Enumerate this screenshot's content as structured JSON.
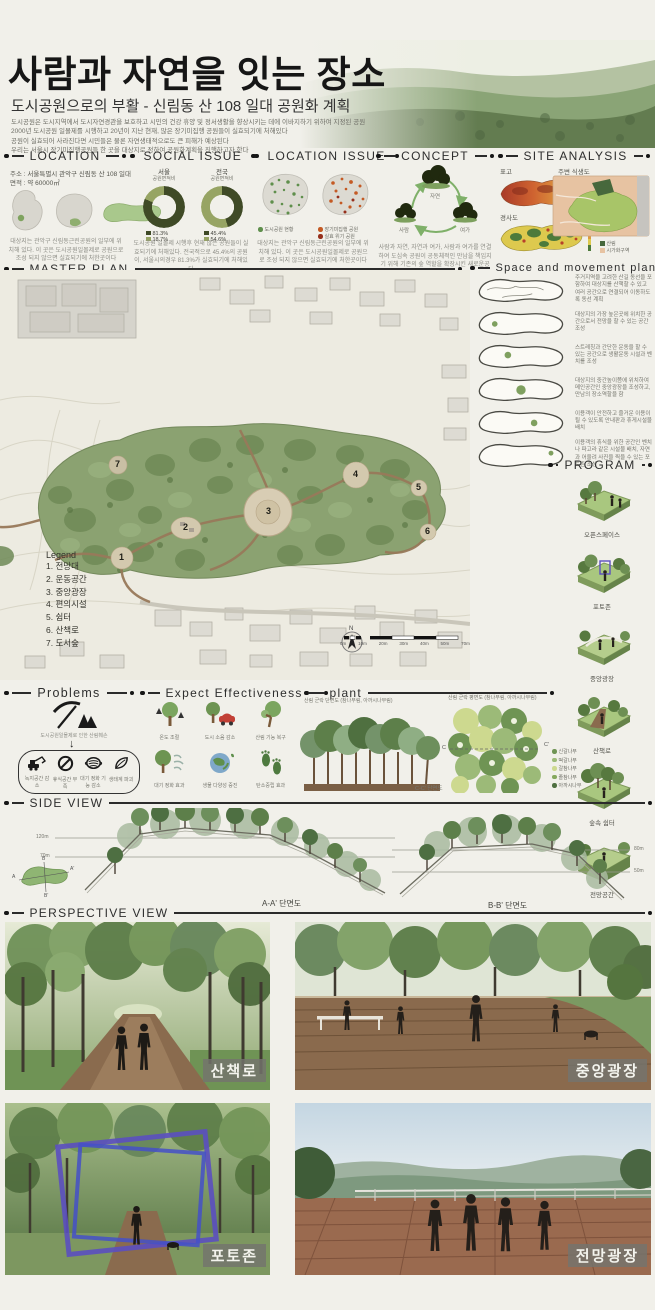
{
  "header": {
    "title": "사람과 자연을 잇는 장소",
    "subtitle": "도시공원으로의 부활 - 신림동 산 108 일대 공원화 계획",
    "desc": [
      "도시공원은 도시지역에서 도시자연경관을 보호하고 시민의 건강 휴양 및 정서생활을 향상시키는 데에 이바지하기 위하여 지정된 공원",
      "2000년 도시공원 일몰제를 시행하고 20년이 지난 현재, 많은 장기미집행 공원들이 실효되기에 처해있다",
      "공원이 실효되어 사라진다면 시민들은 물론 자연생태적으로도 큰 피해가 예상된다",
      "우리는 서울시 장기미집행공원들 한 곳을 대상지로 정하여 공원화계획을 진행하고자 한다"
    ]
  },
  "location": {
    "heading": "LOCATION",
    "address": "주소 : 서울특별시 관악구 신림동 산 108 일대",
    "area": "면적 : 약 60000㎡",
    "caption": "대상지는 관악구 신림동근린공원의 일부에 위치해 있다. 이 곳은 도시공원일몰제로 공원으로 조성 되지 않으면 실효되기에 처한곳이다"
  },
  "social_issue": {
    "heading": "SOCIAL ISSUE",
    "charts": [
      {
        "region": "서울",
        "metric": "공원면적비",
        "values": [
          "81.3%",
          "18.7%"
        ]
      },
      {
        "region": "전국",
        "metric": "공원면적비",
        "values": [
          "45.4%",
          "54.6%"
        ]
      }
    ],
    "caption": "도시공원 일몰제 시행후 현재 많은 공원들이 실효되기에 처해있다. 전국적으로 45.4%의 공원이, 서울시의경우 81.3%가 실효되기에 처해있다"
  },
  "location_issue": {
    "heading": "LOCATION ISSUE",
    "map1_legend": [
      "도시공원 현황"
    ],
    "map2_legend": [
      "장기미집행 공원",
      "실효 위기 공원"
    ],
    "caption": "대상지는 관악구 신림동근린공원의 일부에 위치해 있다. 이 곳은 도시공원일몰제로 공원으로 조성 되지 않으면 실효되기에 처한곳이다"
  },
  "concept": {
    "heading": "CONCEPT",
    "nodes": [
      "자연",
      "사람",
      "여가"
    ],
    "caption": "사람과 자연, 자연과 여가, 사람과 여가를 연결하여 도심속 공원이 공동체적인 만남을 책임지기 위해 기존의 숲 역할을 확장시킨 새로운공간"
  },
  "site_analysis": {
    "heading": "SITE ANALYSIS",
    "labels": [
      "표고",
      "경사도",
      "주변 식생도"
    ],
    "veg_legend": [
      "산림",
      "시가화구역"
    ]
  },
  "master_plan": {
    "heading": "MASTER PLAN",
    "legend_title": "Legend",
    "legend_items": [
      "1. 전망대",
      "2. 운동공간",
      "3. 중앙광장",
      "4. 편의시설",
      "5. 쉼터",
      "6. 산책로",
      "7. 도서숲"
    ],
    "markers": [
      "1",
      "2",
      "3",
      "4",
      "5",
      "6",
      "7"
    ],
    "north": "N",
    "scale_ticks": [
      "0m",
      "10m",
      "20m",
      "30m",
      "40m",
      "50m",
      "70m"
    ]
  },
  "space_movement": {
    "heading": "Space and movement plan",
    "rows": [
      {
        "text": "주거지역을 고려한 산길 동선을 포함하여 대상지를 산책할 수 있고 여러 공간으로 연결되어 이동하도록 동선 계획"
      },
      {
        "text": "대상지의 가장 높은곳에 위치한 공간으로서 전망을 할 수 있는 공간 조성"
      },
      {
        "text": "스트레칭과 간단한 운동을 할 수 있는 공간으로 생활운동 시설과 벤치를 조성"
      },
      {
        "text": "대상지의 중간높이쯤에 위치하여 메인공간인 중앙광장을 조성하고, 만남의 장소역할을 함"
      },
      {
        "text": "이용객이 안전하고 즐거운 이용이 될 수 있도록 안내판과 휴게시설물 배치"
      },
      {
        "text": "이용객의 휴식을 위한 공간인 벤치나 파고라 같은 시설물 배치, 자연과 어울려 사진을 찍을 수 있는 포토존 조성"
      }
    ]
  },
  "program": {
    "heading": "PROGRAM",
    "items": [
      "오픈스페이스",
      "포토존",
      "중앙광장",
      "산책로",
      "숲속 쉼터",
      "전망공간"
    ]
  },
  "problems": {
    "heading": "Problems",
    "cause": "도시공원일몰제로 인한 산림훼손",
    "effects": [
      "녹지공간 감소",
      "휴식공간 부족",
      "대기 정화 기능 감소",
      "생태계 파괴"
    ]
  },
  "effectiveness": {
    "heading": "Expect Effectiveness",
    "items": [
      "온도 조절",
      "도시 소음 감소",
      "산림 기능 복구",
      "대기 정화 효과",
      "생물 다양성 증진",
      "탄소중립 효과"
    ]
  },
  "plant": {
    "heading": "plant",
    "section_title": "산림 군락 단면도 (참나무림, 아까시나무림)",
    "plan_title": "산림 군락 평면도 (참나무림, 아까시나무림)",
    "section_caption": "C-C' 단면도",
    "cut_labels": [
      "C",
      "C'"
    ],
    "legend": [
      "신갈나무",
      "떡갈나무",
      "갈참나무",
      "졸참나무",
      "아까시나무"
    ]
  },
  "side_view": {
    "heading": "SIDE VIEW",
    "a_label": "A-A' 단면도",
    "b_label": "B-B' 단면도",
    "a_elev": [
      "120m",
      "70m"
    ],
    "b_elev": [
      "80m",
      "50m"
    ],
    "inset": [
      "A",
      "A'",
      "B",
      "B'"
    ]
  },
  "perspective": {
    "heading": "PERSPECTIVE VIEW",
    "labels": [
      "산책로",
      "중앙광장",
      "포토존",
      "전망광장"
    ]
  },
  "colors": {
    "background": "#f1f0ea",
    "ink": "#1c1c1c",
    "olive_dark": "#3f4a26",
    "olive_light": "#97a464",
    "park_green": "#87a06c",
    "path_brown": "#96795b"
  }
}
